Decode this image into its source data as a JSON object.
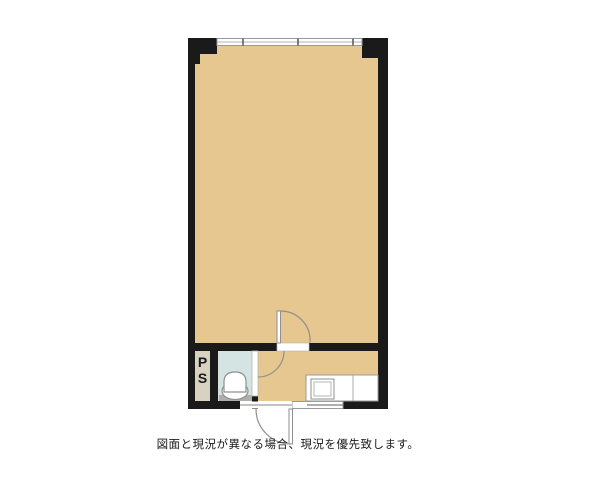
{
  "caption": {
    "text": "図面と現況が異なる場合、現況を優先致します。"
  },
  "plan": {
    "ps_room": {
      "label_line1": "P",
      "label_line2": "S"
    }
  },
  "colors": {
    "background": "#ffffff",
    "wall": "#1a1a1a",
    "room": "#e5c78f",
    "ps": "#d8d2c1",
    "toilet": "#d4e4e2",
    "fixture-line": "#8f8f8f",
    "window-line": "#9a9a9a",
    "threshold": "#b0aeab",
    "text": "#1a1a1a"
  }
}
